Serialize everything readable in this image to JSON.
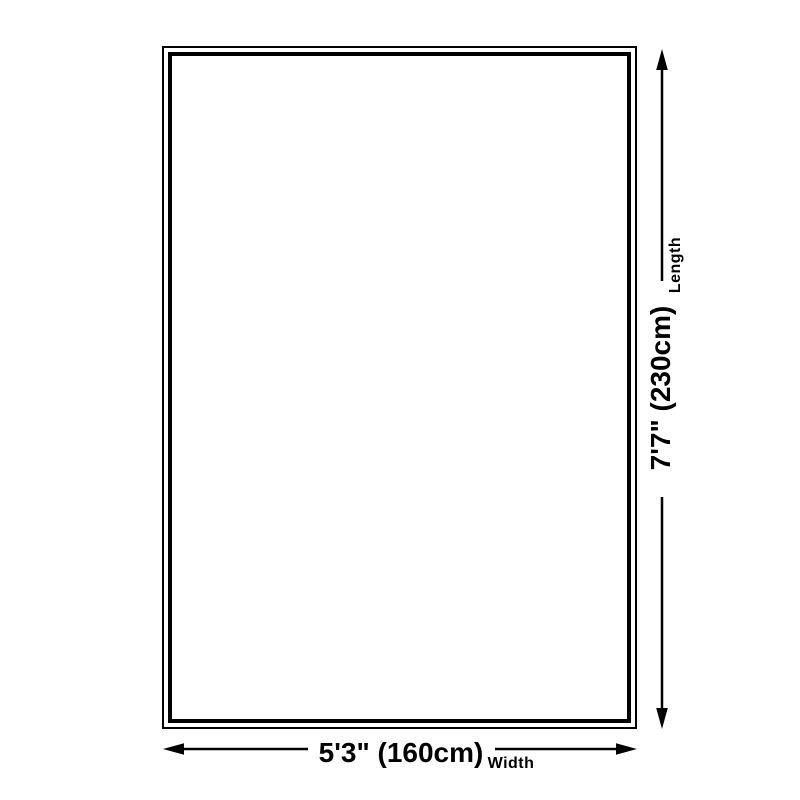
{
  "diagram": {
    "title": "rug-size-diagram",
    "length": {
      "label": "Length",
      "value": "7'7\" (230cm)"
    },
    "width": {
      "label": "Width",
      "value": "5'3\" (160cm)"
    },
    "colors": {
      "line": "#000000",
      "background": "#ffffff"
    }
  }
}
